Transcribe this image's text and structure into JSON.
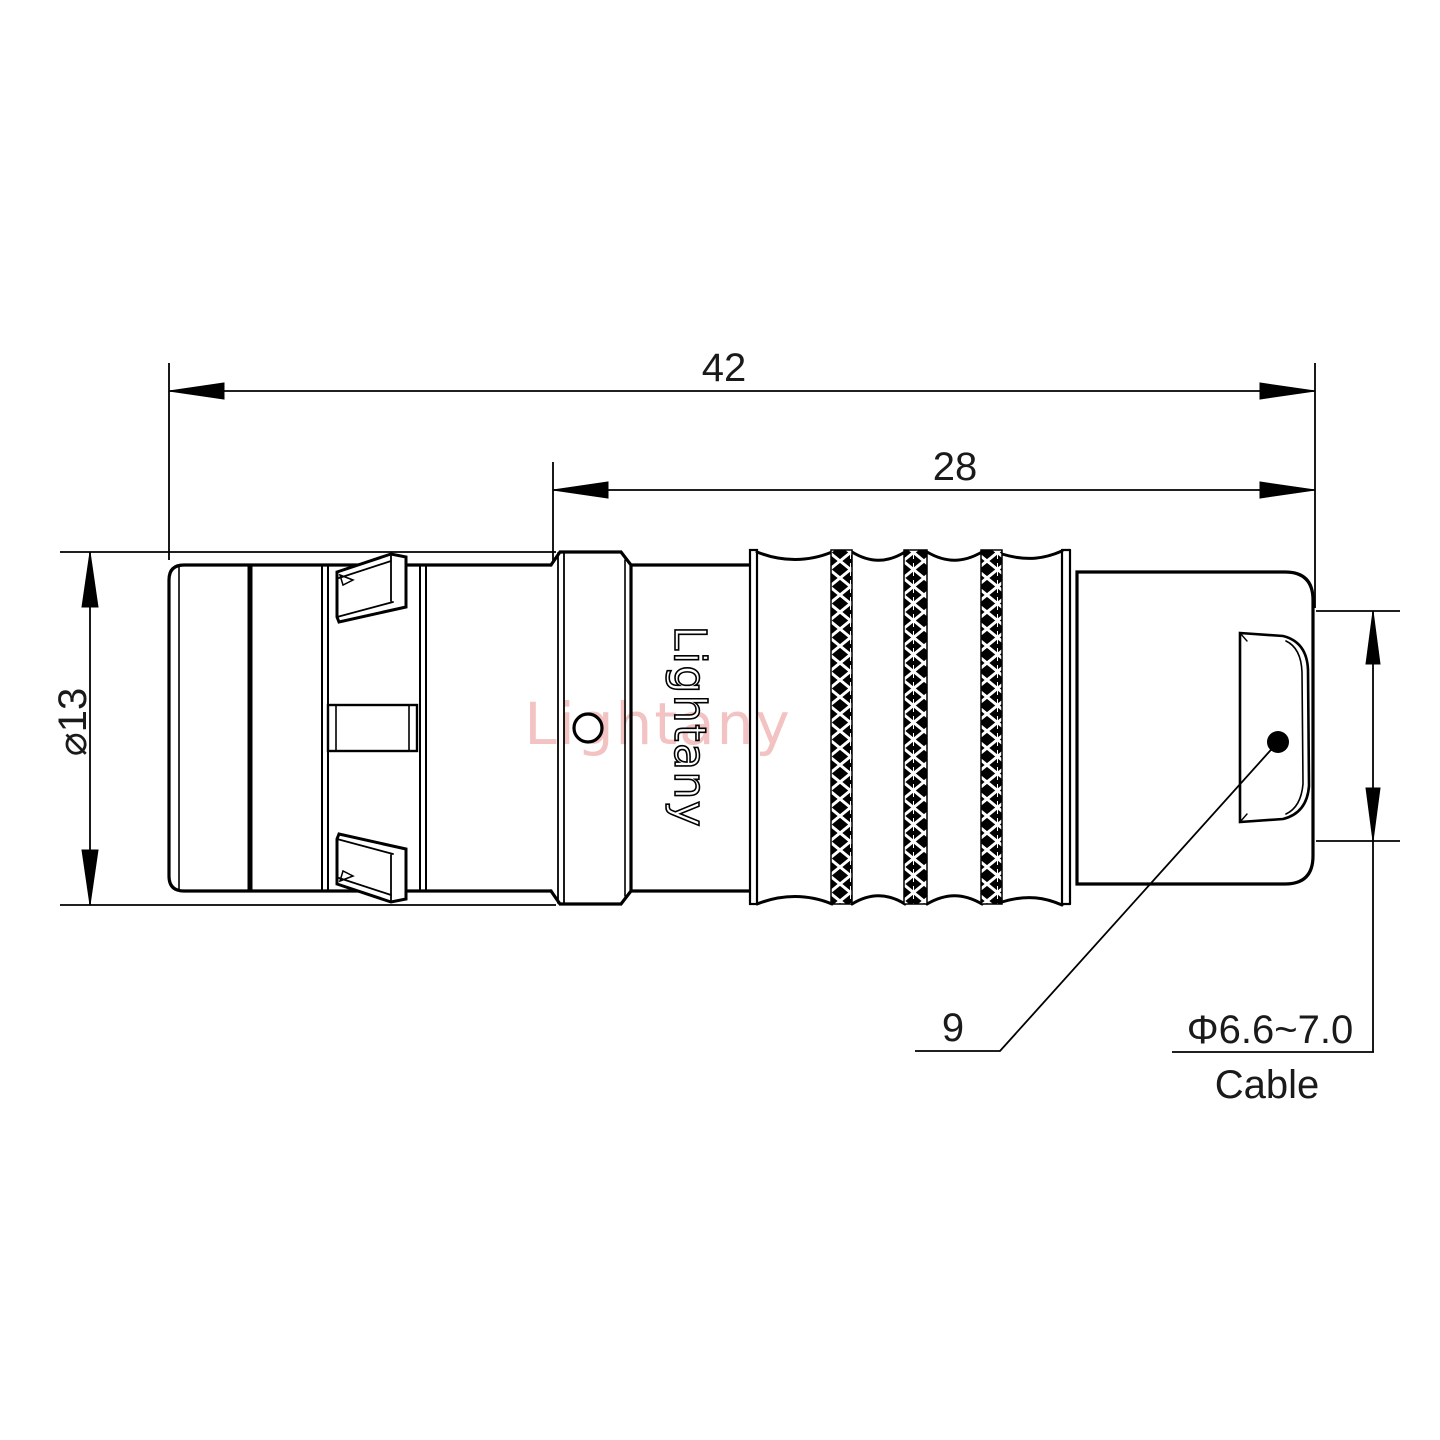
{
  "title": "Connector engineering drawing",
  "dimensions": {
    "overall_length": "42",
    "front_to_rear_length": "28",
    "shell_diameter": "⌀13",
    "rear_section_length": "9",
    "cable_diameter": "Φ6.6~7.0",
    "cable_label": "Cable"
  },
  "branding": {
    "engraving": "Lightany",
    "watermark": "Lightany"
  },
  "colors": {
    "line": "#000000",
    "watermark_pink": "#f2b8b8",
    "background": "#ffffff"
  }
}
